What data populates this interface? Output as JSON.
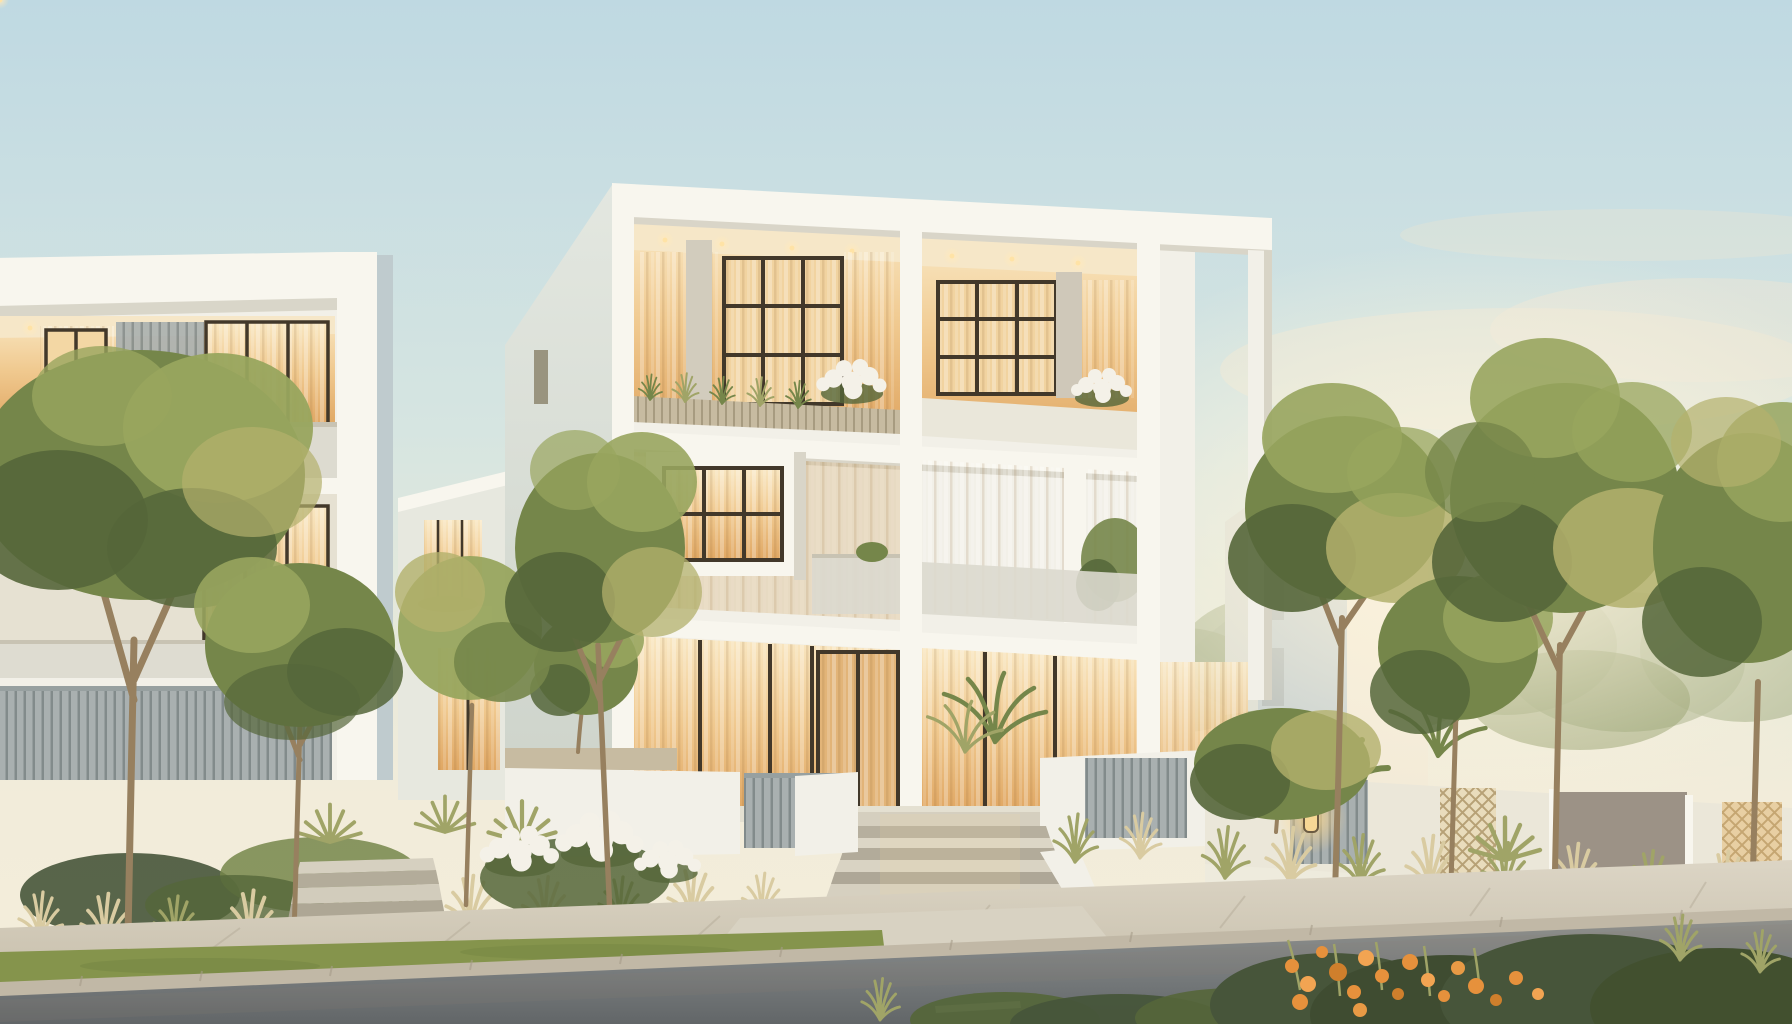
{
  "scene": {
    "type": "photorealistic architectural rendering",
    "subject": "Modern minimalist white villas at dusk",
    "time_of_day": "dusk / golden hour",
    "setting": "residential street with landscaped front gardens, ornamental grasses, street trees, pale sidewalk and asphalt road",
    "lighting": "warm amber glow from floor-to-ceiling curtained windows and recessed ceiling spotlights; pale blue sky fading to a peach sunset haze on the right",
    "visible_text": [],
    "objects": [
      "three-storey white cubic villa with grid facade, recessed balconies, grass planters and white flowering shrubs",
      "open white portico frame on the right corner of the main villa",
      "left neighbouring white villa with frosted-glass balconies and louvered screen fence",
      "background white house with shaded balcony niches",
      "wide entrance steps flanked by low white walls and slat gates",
      "boundary wall with gray slat panels, lattice screens, taupe gate and wall lantern",
      "slender street trees with round canopies, agaves, fan palm and banana plants",
      "white flower bush, wheat-coloured ornamental grasses, lawn strip",
      "asphalt road with dashed white lane markings",
      "orange marigold flower bed in the bottom-right foreground"
    ]
  },
  "palette": {
    "sky_top": "#bfd9e2",
    "sky_mid": "#d6e5e1",
    "sky_horizon": "#f2ecda",
    "cloud": "#efe7d4",
    "wall_white": "#f2f0e8",
    "wall_bright": "#f8f6ee",
    "wall_shadow": "#d8dbd3",
    "wall_side": "#cfd5cd",
    "wall_blue": "#bfcbce",
    "parapet": "#eae7da",
    "rail_frost": "#dbd9ce",
    "planter_wood": "#c7bba1",
    "frame_dark": "#42382a",
    "int_warm_hi": "#f9e7c2",
    "int_warm_lo": "#e0a763",
    "ceiling_warm": "#f6e7c8",
    "slat_gray": "#a9b0b0",
    "slat_dark": "#828b8b",
    "wall_taupe": "#9c9286",
    "lattice": "#e9dcbc",
    "green_dark": "#55663a",
    "green_mid": "#75864a",
    "green_light": "#98a55e",
    "green_warm": "#b3b06c",
    "bush_dark": "#47553a",
    "tree_haze": "#a8b28c",
    "trunk": "#97805f",
    "trunk_dark": "#6e5c42",
    "lawn": "#85944c",
    "grass_wheat": "#d9cba1",
    "grass_green": "#a0a467",
    "sidewalk_hi": "#dcd5c5",
    "sidewalk_lo": "#c8c0ad",
    "paver": "#b3aa97",
    "curb": "#c1b8a6",
    "road_top": "#90908b",
    "road_mid": "#7e8283",
    "road_dark": "#626668",
    "lane": "#ececdf",
    "flower_white": "#f4f1e8",
    "flower_orange": "#e6913c",
    "lamp_glow": "#ffd98e",
    "spot_glow": "#ffe9bc",
    "sun_glow": "#fdf4dd"
  }
}
